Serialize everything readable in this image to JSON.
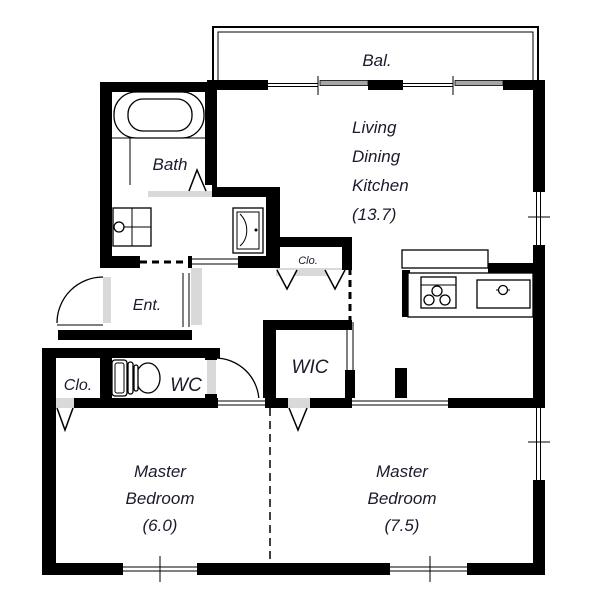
{
  "rooms": {
    "balcony": "Bal.",
    "ldk": [
      "Living",
      "Dining",
      "Kitchen",
      "(13.7)"
    ],
    "bath": "Bath",
    "entrance": "Ent.",
    "hall_closet": "Clo.",
    "toilet": "WC",
    "walk_in_closet": "WIC",
    "bedroom_closet": "Clo.",
    "master_bedroom_6": [
      "Master",
      "Bedroom",
      "(6.0)"
    ],
    "master_bedroom_7_5": [
      "Master",
      "Bedroom",
      "(7.5)"
    ]
  },
  "colors": {
    "wall": "#000000",
    "text": "#1b1b2e",
    "floor_shade": "#d9d9d9",
    "window_pane": "#a6a6a6",
    "background": "#ffffff"
  }
}
